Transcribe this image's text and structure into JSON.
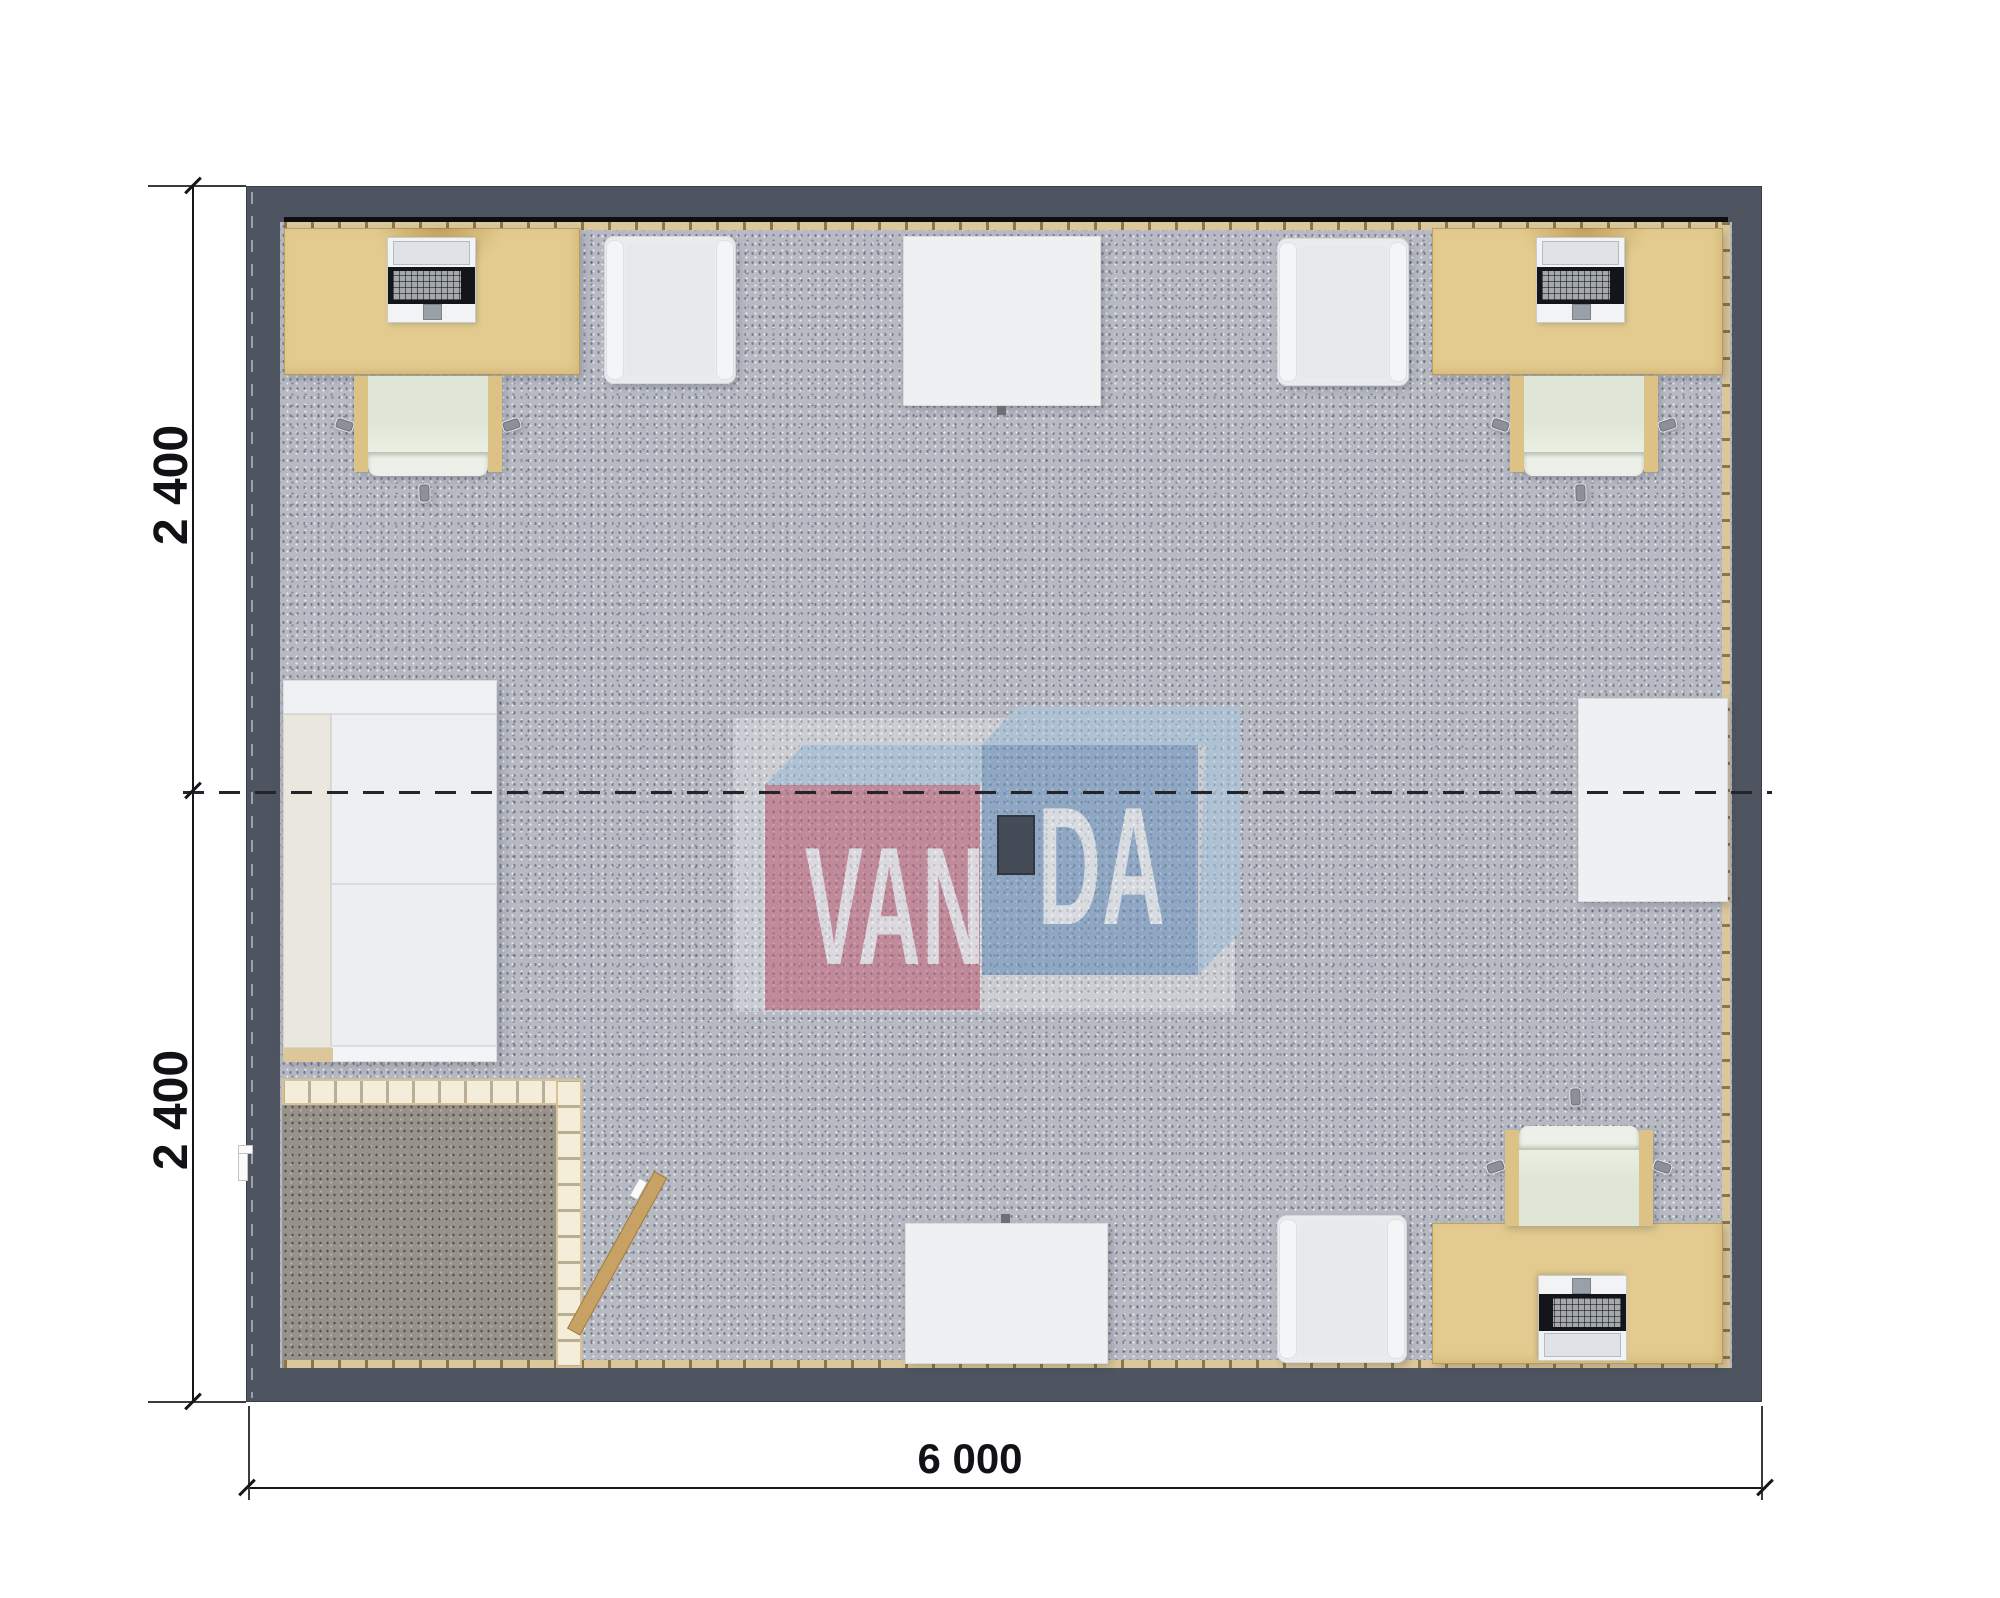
{
  "plan": {
    "type": "modular-office-floor-plan-top-view",
    "dimensions": {
      "left_top_label": "2 400",
      "left_bottom_label": "2 400",
      "bottom_label": "6 000"
    },
    "watermark": {
      "text_left": "VAN",
      "text_right": "DA"
    },
    "colors": {
      "wall": "#4e5560",
      "carpet": "#b7bac3",
      "vestibule": "#97928a",
      "desk": "#e3cb8f",
      "base_beige": "#dcc79b",
      "chair_arm": "#dcc285",
      "chair_seat": "#dfe6d8",
      "lounge": "#e9ebed",
      "table": "#eef0f2",
      "partition": "#f3edda",
      "door": "#c8a265",
      "logo_pink": "#c85f76",
      "logo_blue": "#6b97c2",
      "logo_light": "#a7cbe4"
    },
    "furniture": [
      "desk-top-left",
      "laptop-top-left",
      "task-chair-top-left",
      "lounge-chair-top-left",
      "table-top",
      "lounge-chair-top-right",
      "desk-top-right",
      "laptop-top-right",
      "task-chair-top-right",
      "sofa-left",
      "vestibule-partition",
      "entry-door",
      "table-bottom",
      "lounge-chair-bottom",
      "table-right",
      "desk-bottom-right",
      "computer-bottom-right",
      "task-chair-bottom-right",
      "ceiling-projector"
    ]
  }
}
